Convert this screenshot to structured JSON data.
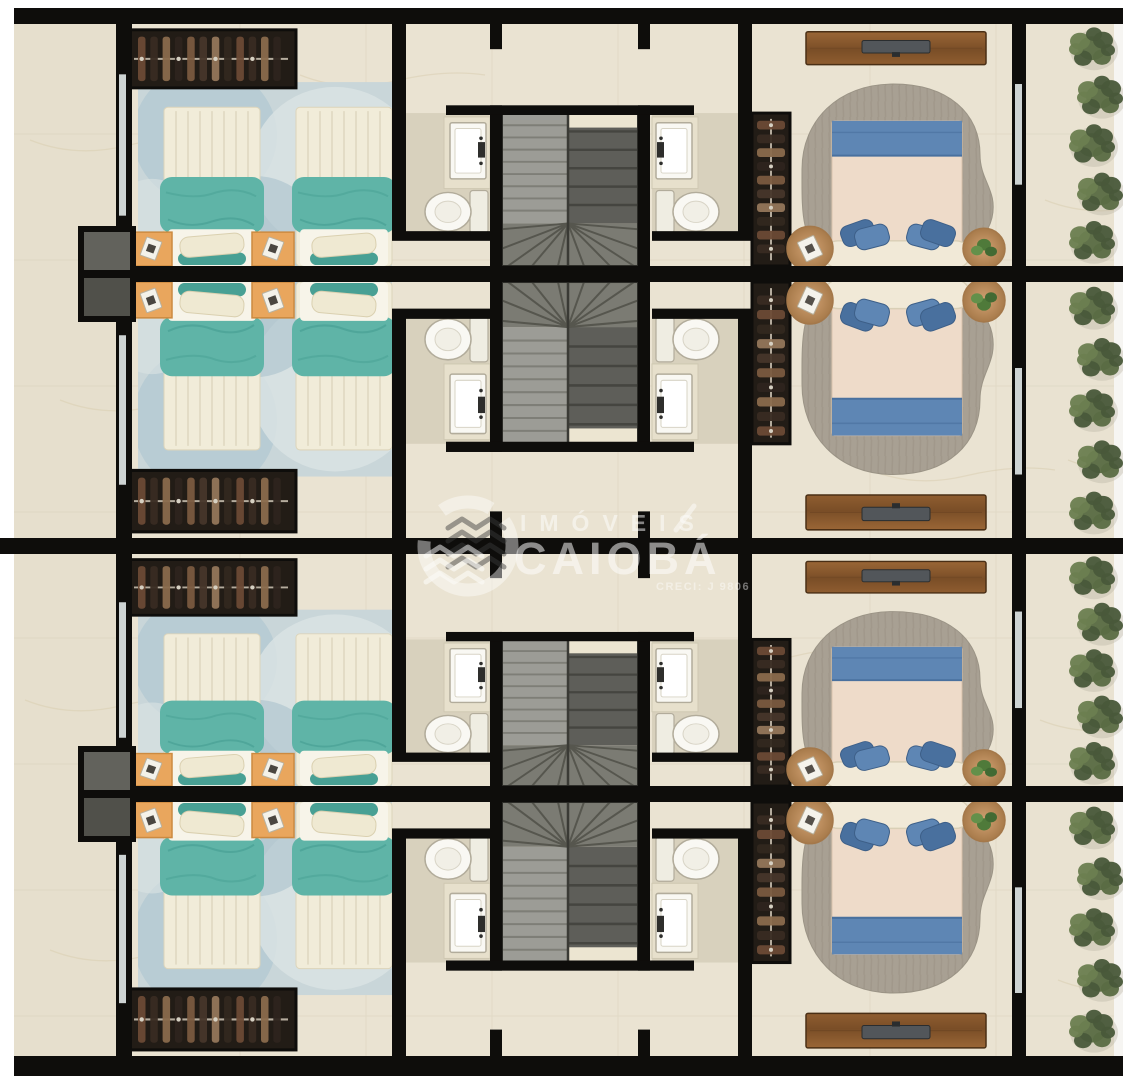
{
  "document": {
    "type": "floor-plan-rendering",
    "description": "Top-down 3D rendered floor plan of four mirrored residential townhouse units"
  },
  "watermark": {
    "brand_top": "IMÓVEIS",
    "brand_main": "CAIOBÁ",
    "registration": "CRECI: J 9806"
  },
  "palette": {
    "floor": "#eae3d2",
    "floor_outside": "#e6dfcd",
    "floor_balcony": "#e9e2d1",
    "tile": "#d9d1bc",
    "vein": "#d8cdb0",
    "wall": "#0e0d0b",
    "glass": "#cdd3d3",
    "niche_dark": "#62625c",
    "niche_darker": "#50504a",
    "rug_twin": "#c9d6d9",
    "rug_twin_c1": "#b2c8d1",
    "rug_twin_c2": "#dbe3e3",
    "rug_twin_c3": "#a5bfca",
    "bed_cream": "#f1ecd9",
    "bed_quilt": "#ded7bf",
    "teal": "#5fb4a7",
    "teal_dark": "#48a094",
    "pillow_cream": "#efe9d2",
    "footer_white": "#f7f4e9",
    "nightstand": "#e9a65d",
    "nightstand_edge": "#cc8a40",
    "wardrobe": "#221c16",
    "wardrobe_rail": "#b5ac9e",
    "clothes": [
      "#6b4a35",
      "#392b22",
      "#8a6a4c",
      "#2e241d",
      "#7a5a3f",
      "#47362a",
      "#93765a",
      "#33281f"
    ],
    "bath_floor": "#d8d1bd",
    "vanity": "#e7e0cc",
    "fixture_white": "#f9f8f3",
    "fixture_edge": "#b2ac9b",
    "faucet": "#2e2e2c",
    "stair_left": "#9c9c96",
    "stair_left_line": "#7e7e77",
    "stair_right": "#5e5e59",
    "stair_right_line": "#454540",
    "stair_winder": "#7b7b73",
    "stair_winder_line": "#56564e",
    "stair_border": "#2b2b27",
    "landing": "#ece5d1",
    "master_rug": "#a8a093",
    "master_duvet": "#eedbc9",
    "master_blue": "#5e86b4",
    "master_blue_dark": "#49709e",
    "headboard": "#f1e9d7",
    "tv": "#52565a",
    "tv_dark": "#2a2d2f",
    "table_wood_edge": "#a4784a",
    "plant_dark": "#49583a",
    "plant_mid": "#5a6b43",
    "plant_light": "#6c7e50",
    "plant_shadow": "#b5af9e",
    "watermark_light": "#ffffff",
    "watermark_dark": "#3b3b3b"
  },
  "layout": {
    "width": 1123,
    "height": 1080,
    "rows": [
      {
        "name": "unit-1",
        "y": 24,
        "h": 242,
        "mirrored": false
      },
      {
        "name": "unit-2",
        "y": 282,
        "h": 256,
        "mirrored": true
      },
      {
        "name": "unit-3",
        "y": 554,
        "h": 232,
        "mirrored": false
      },
      {
        "name": "unit-4",
        "y": 802,
        "h": 254,
        "mirrored": true
      }
    ],
    "rooms_per_unit": [
      "twin-bedroom",
      "hall",
      "bathroom-left",
      "staircase",
      "bathroom-right",
      "wardrobe-closet",
      "master-bedroom",
      "balcony-garden"
    ]
  }
}
